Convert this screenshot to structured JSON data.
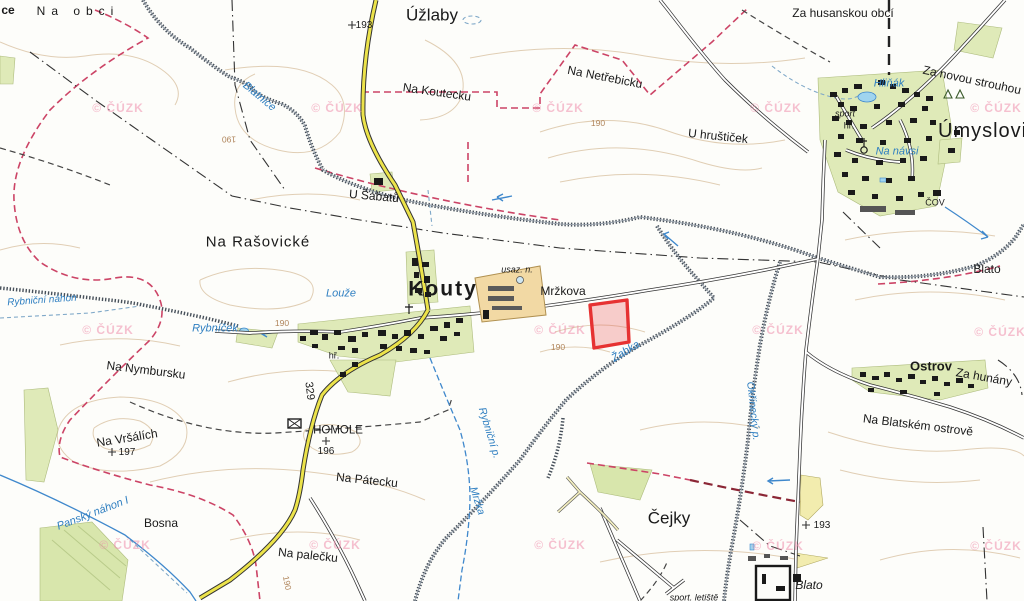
{
  "map": {
    "name": "Kouty / Úmyslovice topographic cadastral map",
    "copyright_text": "© ČÚZK",
    "highlighted_parcel": {
      "color": "#e63232",
      "near_label": "Mržkova",
      "points": "590,305 627,300 629,342 594,348"
    },
    "road_number": "329",
    "colors": {
      "road_yellow": "#ece34a",
      "village_green": "#dfeab8",
      "industrial_tan": "#f2d9a4",
      "water_blue": "#3f88cc",
      "boundary_pink": "#cc4466",
      "contour_tan": "#dcc6a8",
      "watermark_pink": "#ef8fac",
      "parcel_red": "#e63232"
    }
  },
  "labels": [
    {
      "name": "label-ce",
      "text": "ce",
      "x": 8,
      "y": 10,
      "cls": "lbl bold",
      "fs": 12
    },
    {
      "name": "label-na-obci",
      "text": "Na obci",
      "x": 78,
      "y": 11,
      "cls": "lbl sp",
      "fs": 12
    },
    {
      "name": "label-uzlaby",
      "text": "Úžlaby",
      "x": 432,
      "y": 15,
      "cls": "lbl big"
    },
    {
      "name": "label-elev-193-top",
      "text": "193",
      "x": 364,
      "y": 26,
      "cls": "lbl num"
    },
    {
      "name": "label-za-husanskou-obci",
      "text": "Za husanskou obcí",
      "x": 843,
      "y": 13,
      "cls": "lbl",
      "fs": 12
    },
    {
      "name": "label-za-novou-strouhou",
      "text": "Za novou strouhou",
      "x": 972,
      "y": 80,
      "cls": "lbl",
      "fs": 12,
      "rot": 12
    },
    {
      "name": "label-na-koutecku",
      "text": "Na Koutecku",
      "x": 437,
      "y": 92,
      "cls": "lbl",
      "fs": 12,
      "rot": 8
    },
    {
      "name": "label-na-netrebicku",
      "text": "Na Netřebicku",
      "x": 605,
      "y": 77,
      "cls": "lbl",
      "fs": 12,
      "rot": 11
    },
    {
      "name": "label-u-hrusticek",
      "text": "U hruštiček",
      "x": 718,
      "y": 136,
      "cls": "lbl",
      "fs": 12,
      "rot": 6
    },
    {
      "name": "label-umyslovice",
      "text": "Úmyslovice",
      "x": 938,
      "y": 131,
      "cls": "lbl town left"
    },
    {
      "name": "label-sport-umyslovice",
      "text": "sport",
      "x": 845,
      "y": 114,
      "cls": "lbl small ital"
    },
    {
      "name": "label-hriste-umyslovice",
      "text": "hř.",
      "x": 849,
      "y": 126,
      "cls": "lbl small"
    },
    {
      "name": "label-hlinak",
      "text": "Hliňák",
      "x": 889,
      "y": 84,
      "cls": "lbl water"
    },
    {
      "name": "label-na-navsi",
      "text": "Na návsi",
      "x": 897,
      "y": 152,
      "cls": "lbl water"
    },
    {
      "name": "label-cov",
      "text": "ČOV",
      "x": 935,
      "y": 203,
      "cls": "lbl small"
    },
    {
      "name": "label-u-sabatu",
      "text": "U Šabatů",
      "x": 374,
      "y": 196,
      "cls": "lbl",
      "fs": 12,
      "rot": 5
    },
    {
      "name": "label-na-rasovicke",
      "text": "Na Rašovické",
      "x": 258,
      "y": 242,
      "cls": "lbl med"
    },
    {
      "name": "label-blato-east",
      "text": "Blato",
      "x": 987,
      "y": 269,
      "cls": "lbl",
      "fs": 12
    },
    {
      "name": "label-kouty",
      "text": "Kouty",
      "x": 443,
      "y": 289,
      "cls": "lbl huge"
    },
    {
      "name": "label-usaz-n",
      "text": "usaz. n.",
      "x": 517,
      "y": 270,
      "cls": "lbl small ital"
    },
    {
      "name": "label-mrzkova",
      "text": "Mržkova",
      "x": 563,
      "y": 291,
      "cls": "lbl",
      "fs": 12
    },
    {
      "name": "label-hriste-kouty",
      "text": "hř.",
      "x": 334,
      "y": 356,
      "cls": "lbl small"
    },
    {
      "name": "label-louze",
      "text": "Louže",
      "x": 341,
      "y": 294,
      "cls": "lbl water"
    },
    {
      "name": "label-rybnicek",
      "text": "Rybníček",
      "x": 215,
      "y": 329,
      "cls": "lbl water"
    },
    {
      "name": "label-rybnicni-nahon",
      "text": "Rybniční náhon",
      "x": 42,
      "y": 301,
      "cls": "lbl water",
      "fs": 10,
      "rot": -4
    },
    {
      "name": "label-na-nymbursku",
      "text": "Na Nymbursku",
      "x": 146,
      "y": 370,
      "cls": "lbl",
      "fs": 12,
      "rot": 7
    },
    {
      "name": "label-road-329",
      "text": "329",
      "x": 309,
      "y": 391,
      "cls": "lbl",
      "fs": 11,
      "rot": 83
    },
    {
      "name": "label-na-vrsalich",
      "text": "Na Vršálích",
      "x": 127,
      "y": 438,
      "cls": "lbl",
      "fs": 12,
      "rot": -9
    },
    {
      "name": "label-elev-197",
      "text": "197",
      "x": 127,
      "y": 453,
      "cls": "lbl num"
    },
    {
      "name": "label-homole",
      "text": "HOMOLE",
      "x": 338,
      "y": 431,
      "cls": "lbl",
      "fs": 11.5
    },
    {
      "name": "label-elev-196",
      "text": "196",
      "x": 326,
      "y": 452,
      "cls": "lbl num"
    },
    {
      "name": "label-na-patecku",
      "text": "Na Pátecku",
      "x": 367,
      "y": 480,
      "cls": "lbl",
      "fs": 12,
      "rot": 6
    },
    {
      "name": "label-bosna",
      "text": "Bosna",
      "x": 161,
      "y": 523,
      "cls": "lbl",
      "fs": 12
    },
    {
      "name": "label-pansky-nahon",
      "text": "Panský náhon I",
      "x": 93,
      "y": 514,
      "cls": "lbl water",
      "rot": -21
    },
    {
      "name": "label-na-palecku",
      "text": "Na palečku",
      "x": 308,
      "y": 555,
      "cls": "lbl",
      "fs": 12,
      "rot": 6
    },
    {
      "name": "label-cejky",
      "text": "Čejky",
      "x": 669,
      "y": 518,
      "cls": "lbl big"
    },
    {
      "name": "label-ostrov",
      "text": "Ostrov",
      "x": 931,
      "y": 366,
      "cls": "lbl bold",
      "fs": 13
    },
    {
      "name": "label-za-hunany",
      "text": "Za hunány",
      "x": 984,
      "y": 377,
      "cls": "lbl",
      "fs": 12,
      "rot": 10
    },
    {
      "name": "label-na-blatskem-ostrove",
      "text": "Na Blatském ostrově",
      "x": 918,
      "y": 425,
      "cls": "lbl",
      "fs": 12,
      "rot": 7
    },
    {
      "name": "label-blato-south",
      "text": "Blato",
      "x": 809,
      "y": 585,
      "cls": "lbl ital",
      "fs": 12
    },
    {
      "name": "label-elev-193-south",
      "text": "193",
      "x": 822,
      "y": 526,
      "cls": "lbl num"
    },
    {
      "name": "label-sport-letiste",
      "text": "sport. letiště",
      "x": 694,
      "y": 598,
      "cls": "lbl small ital"
    },
    {
      "name": "label-blatnice",
      "text": "Blatnice",
      "x": 259,
      "y": 97,
      "cls": "lbl water",
      "rot": 40
    },
    {
      "name": "label-zabka",
      "text": "Žabka",
      "x": 626,
      "y": 352,
      "cls": "lbl water",
      "rot": -31
    },
    {
      "name": "label-rybnicni-p",
      "text": "Rybniční p.",
      "x": 489,
      "y": 433,
      "cls": "lbl water",
      "fs": 10.5,
      "rot": 73
    },
    {
      "name": "label-mrzka",
      "text": "Mržka",
      "x": 477,
      "y": 501,
      "cls": "lbl water",
      "fs": 10.5,
      "rot": 72
    },
    {
      "name": "label-okrinecky-p",
      "text": "Okřínecký p.",
      "x": 753,
      "y": 411,
      "cls": "lbl water",
      "fs": 10.5,
      "rot": 84
    },
    {
      "name": "label-contour-190-a",
      "text": "190",
      "x": 598,
      "y": 123,
      "cls": "lbl contour csize"
    },
    {
      "name": "label-contour-190-b",
      "text": "190",
      "x": 282,
      "y": 323,
      "cls": "lbl contour csize"
    },
    {
      "name": "label-contour-190-c",
      "text": "190",
      "x": 558,
      "y": 347,
      "cls": "lbl contour csize"
    },
    {
      "name": "label-contour-190-d",
      "text": "190",
      "x": 229,
      "y": 139,
      "cls": "lbl contour csize",
      "rot": 180
    },
    {
      "name": "label-contour-190-e",
      "text": "190",
      "x": 287,
      "y": 583,
      "cls": "lbl contour csize",
      "rot": 78
    }
  ],
  "watermarks": {
    "text": "© ČÚZK",
    "positions": [
      [
        118,
        108
      ],
      [
        337,
        108
      ],
      [
        558,
        108
      ],
      [
        776,
        108
      ],
      [
        996,
        108
      ],
      [
        108,
        330
      ],
      [
        560,
        330
      ],
      [
        778,
        330
      ],
      [
        1000,
        332
      ],
      [
        125,
        545
      ],
      [
        335,
        545
      ],
      [
        560,
        545
      ],
      [
        778,
        546
      ],
      [
        996,
        546
      ]
    ]
  }
}
